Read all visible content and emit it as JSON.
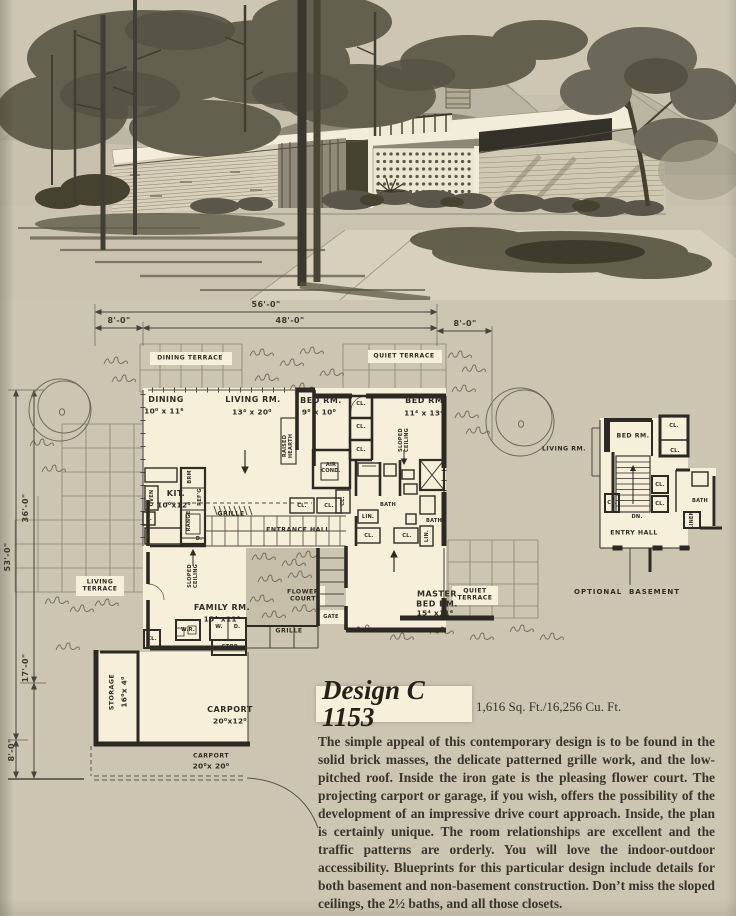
{
  "colors": {
    "paper": "#cbc5b1",
    "cream": "#f6efd9",
    "ink": "#2c2a21",
    "grid": "#8b8570"
  },
  "dims": {
    "total_width": "56'-0\"",
    "left_offset": "8'-0\"",
    "house_width": "48'-0\"",
    "right_offset": "8'-0\"",
    "total_depth": "53'-0\"",
    "upper_depth": "36'-0\"",
    "lower_depth": "17'-0\"",
    "carport_offset": "8'-0\""
  },
  "plan": {
    "dining_terrace": "DINING TERRACE",
    "quiet_terrace_top": "QUIET TERRACE",
    "dining": "DINING",
    "dining_size": "10⁰ x 11⁶",
    "living": "LIVING RM.",
    "living_size": "13⁴ x 20⁰",
    "bed1": "BED RM.",
    "bed1_size": "9⁰ x 10⁰",
    "bed2": "BED RM.",
    "bed2_size": "11⁴ x 13⁴",
    "raised_hearth": "RAISED\nHEARTH",
    "sloped_ceiling": "SLOPED\nCEILING",
    "air_cond": "AIR\nCOND.",
    "kitchen": "KIT.",
    "kitchen_size": "10⁰x12⁰",
    "brm": "BRM",
    "refg": "REF'G",
    "range": "RANGE",
    "oven": "OVEN",
    "sink": "S.",
    "dw": "D.",
    "grille_top": "GRILLE",
    "entrance_hall": "ENTRANCE HALL",
    "living_terrace": "LIVING\nTERRACE",
    "family": "FAMILY RM.",
    "family_size": "15⁴ x11⁶",
    "flower_court": "FLOWER\nCOURT",
    "gate": "GATE",
    "grille_bottom": "GRILLE",
    "master": "MASTER\nBED RM.",
    "master_size": "15⁴ x11⁶",
    "quiet_terrace_bottom": "QUIET\nTERRACE",
    "bath": "BATH",
    "lin": "LIN.",
    "cl": "CL.",
    "wr": "W.R.",
    "washer": "W.",
    "dryer": "D.",
    "stor": "STOR.",
    "storage": "STORAGE",
    "storage_size": "16⁰x 4⁰",
    "carport": "CARPORT",
    "carport_size": "20⁰x12⁰",
    "carport2": "CARPORT",
    "carport2_size": "20⁰x 20⁰"
  },
  "basement_plan": {
    "living": "LIVING RM.",
    "bed": "BED RM.",
    "entry": "ENTRY HALL",
    "bath": "BATH",
    "linen": "LINEN",
    "cl": "CL.",
    "dn": "DN.",
    "caption": "OPTIONAL  BASEMENT"
  },
  "info": {
    "design_no": "Design C 1153",
    "stats": "1,616 Sq. Ft./16,256 Cu. Ft.",
    "description": "The simple appeal of this contemporary design is to be found in the solid brick masses,  the delicate patterned grille work, and the low-pitched roof. Inside the iron gate is the pleasing flower court.  The projecting carport or garage, if you wish, offers the possibility of the development of an impressive drive court approach. Inside, the plan is certainly unique. The room relationships are excellent and the traffic patterns are orderly. You will love the indoor-outdoor accessibility.  Blueprints for this particular design include details for both basement and non-basement construction. Don’t miss the sloped ceilings, the 2½ baths, and all those closets."
  }
}
